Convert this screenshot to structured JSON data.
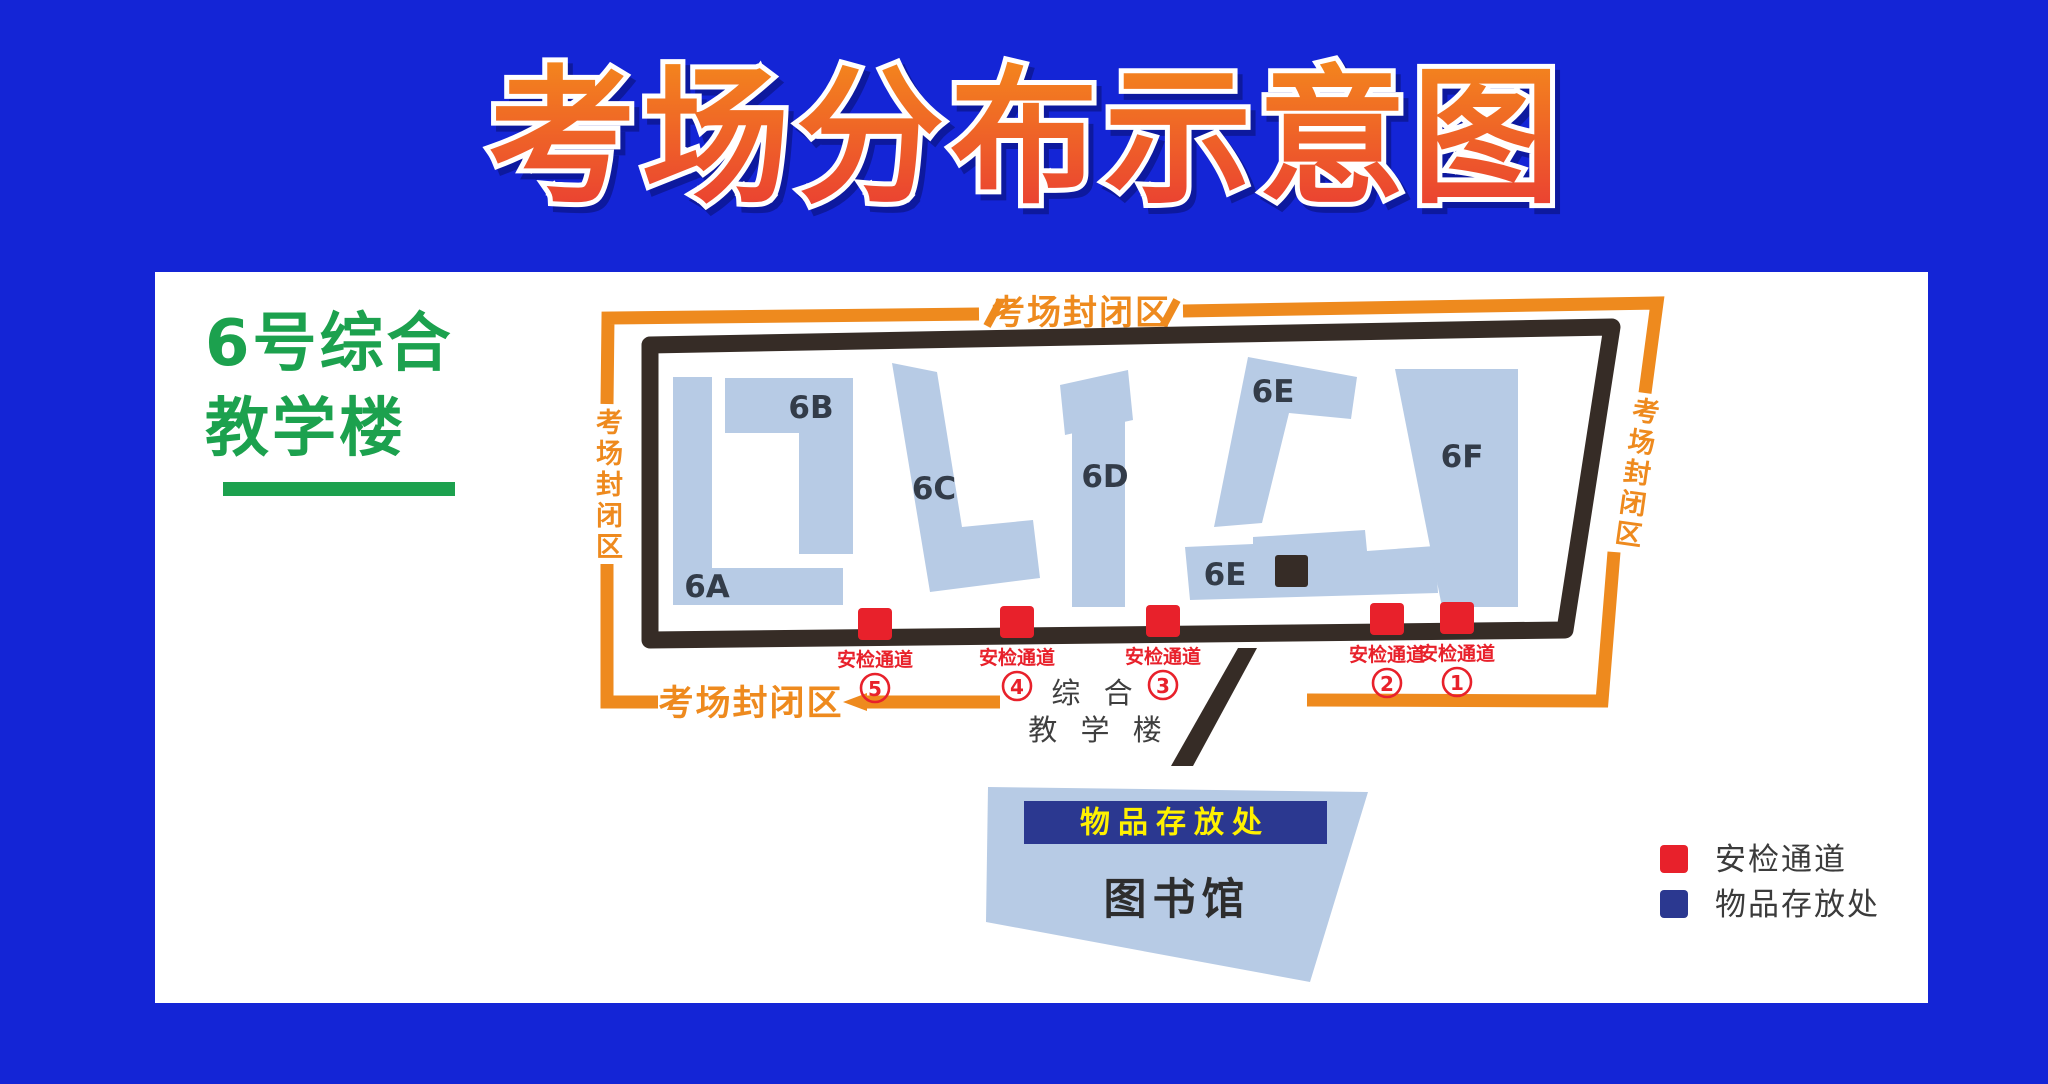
{
  "title": "考场分布示意图",
  "building_heading": {
    "line1": "6号综合",
    "line2": "教学楼"
  },
  "map": {
    "closed_area_labels": {
      "top": "考场封闭区",
      "left": "考场封闭区",
      "right": "考场封闭区",
      "bottom": "考场封闭区"
    },
    "buildings": {
      "b6a": "6A",
      "b6b": "6B",
      "b6c": "6C",
      "b6d": "6D",
      "b6e_upper": "6E",
      "b6e_lower": "6E",
      "b6f": "6F"
    },
    "checkpoints": [
      {
        "label": "安检通道",
        "number": "5"
      },
      {
        "label": "安检通道",
        "number": "4"
      },
      {
        "label": "安检通道",
        "number": "3"
      },
      {
        "label": "安检通道",
        "number": "2"
      },
      {
        "label": "安检通道",
        "number": "1"
      }
    ],
    "teaching_note": {
      "line1": "综 合",
      "line2": "教 学 楼"
    },
    "library": {
      "storage_banner": "物品存放处",
      "name": "图书馆"
    }
  },
  "legend": {
    "items": [
      {
        "label": "安检通道",
        "color": "#E8212B"
      },
      {
        "label": "物品存放处",
        "color": "#2B3890"
      }
    ]
  },
  "colors": {
    "background_blue": "#1425d6",
    "title_gradient_top": "#F4891C",
    "title_gradient_bottom": "#E93A34",
    "closed_area_orange": "#EE8A1E",
    "building_fill": "#B7CBE5",
    "outline_black": "#362C26",
    "checkpoint_red": "#E8212B",
    "storage_navy": "#2B3890",
    "banner_text_yellow": "#FFF100",
    "heading_green": "#1CA14E"
  }
}
